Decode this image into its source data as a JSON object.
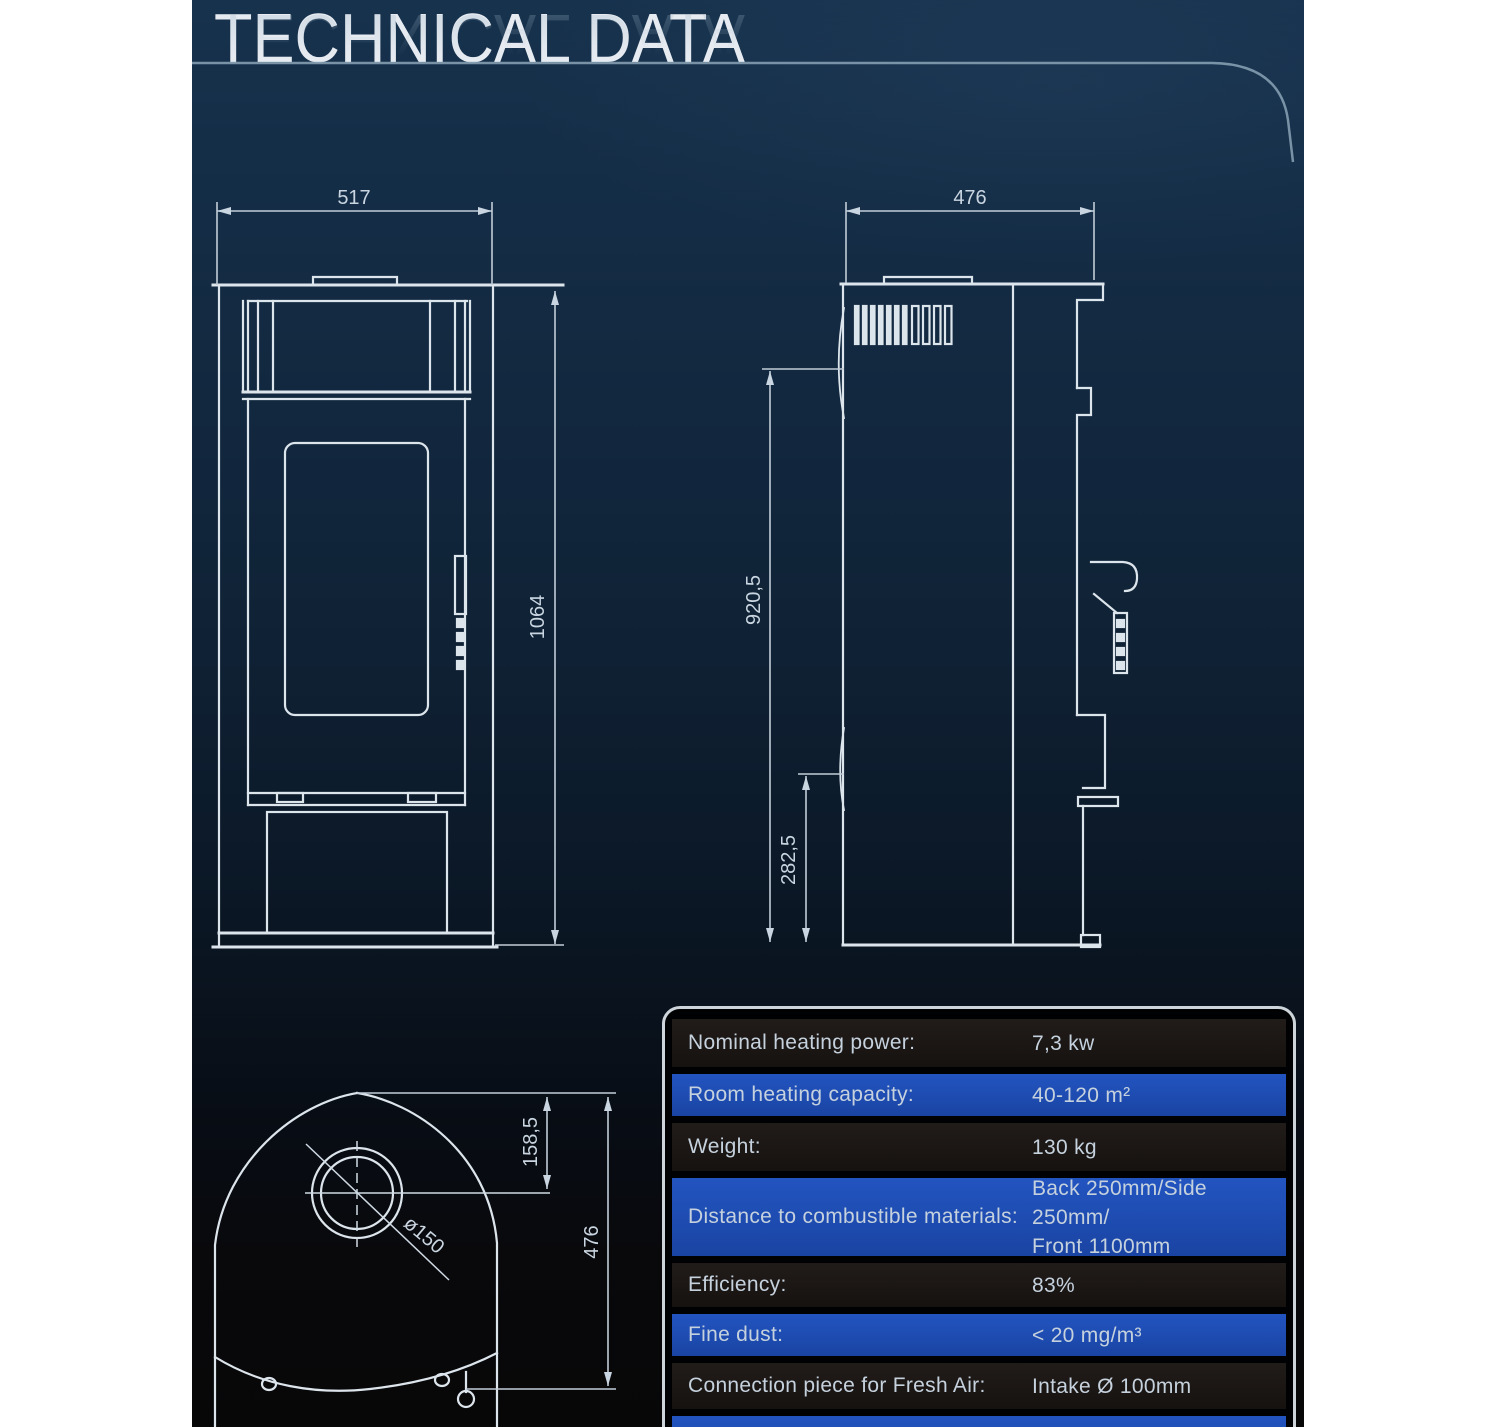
{
  "page": {
    "title": "TECHNICAL DATA"
  },
  "front_view": {
    "width_dim": "517",
    "height_dim": "1064"
  },
  "side_view": {
    "width_dim": "476",
    "height_upper_dim": "920,5",
    "height_lower_dim": "282,5"
  },
  "top_view": {
    "flue_center_dim": "158,5",
    "depth_dim": "476",
    "flue_diameter_dim": "ø150"
  },
  "spec_table": {
    "rows": [
      {
        "label": "Nominal heating power:",
        "value": "7,3 kw"
      },
      {
        "label": "Room heating capacity:",
        "value": "40-120 m²"
      },
      {
        "label": "Weight:",
        "value": "130 kg"
      },
      {
        "label": "Distance to combustible materials:",
        "value": "Back 250mm/Side 250mm/\nFront 1100mm"
      },
      {
        "label": "Efficiency:",
        "value": "83%"
      },
      {
        "label": "Fine dust:",
        "value": "< 20 mg/m³"
      },
      {
        "label": "Connection piece for Fresh Air:",
        "value": "Intake Ø 100mm"
      },
      {
        "label": "",
        "value": ""
      }
    ]
  },
  "colors": {
    "accent_blue": "#1d4cb1",
    "row_dark": "#1a1614",
    "drawing_line": "#dde5ec",
    "background_top": "#17324d",
    "underline": "#8ba3b6"
  }
}
